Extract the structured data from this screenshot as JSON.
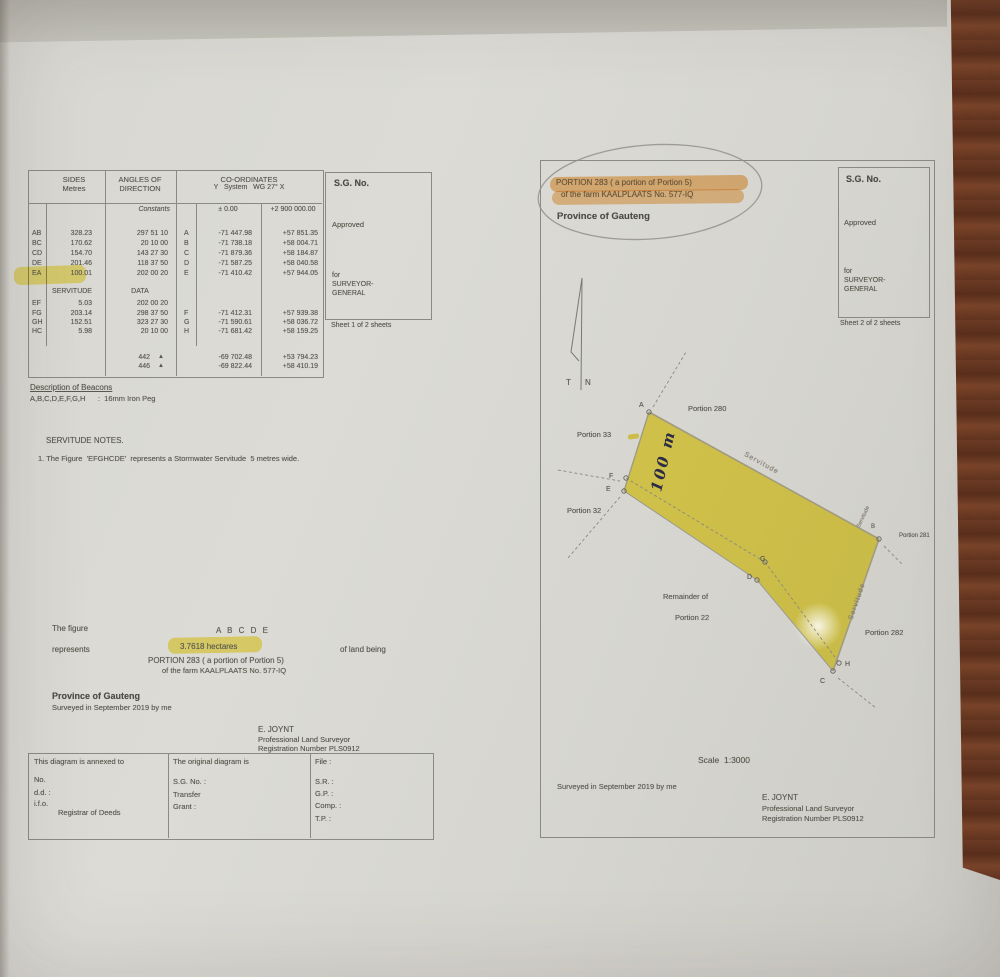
{
  "left_page": {
    "table": {
      "sides_header_1": "SIDES",
      "sides_header_2": "Metres",
      "angles_header_1": "ANGLES OF",
      "angles_header_2": "DIRECTION",
      "coords_header_1": "CO-ORDINATES",
      "coords_header_2": "Y   System   WG 27° X",
      "constants_label": "Constants",
      "const_y": "± 0.00",
      "const_x": "+2 900 000.00",
      "rows": [
        {
          "pair": "AB",
          "metres": "328.23",
          "angle": "297 51 10",
          "pt": "A",
          "y": "-71 447.98",
          "x": "+57 851.35"
        },
        {
          "pair": "BC",
          "metres": "170.62",
          "angle": "20 10 00",
          "pt": "B",
          "y": "-71 738.18",
          "x": "+58 004.71"
        },
        {
          "pair": "CD",
          "metres": "154.70",
          "angle": "143 27 30",
          "pt": "C",
          "y": "-71 879.36",
          "x": "+58 184.87"
        },
        {
          "pair": "DE",
          "metres": "201.46",
          "angle": "118 37 50",
          "pt": "D",
          "y": "-71 587.25",
          "x": "+58 040.58"
        },
        {
          "pair": "EA",
          "metres": "100.01",
          "angle": "202 00 20",
          "pt": "E",
          "y": "-71 410.42",
          "x": "+57 944.05"
        }
      ],
      "servitude_label": "SERVITUDE",
      "data_label": "DATA",
      "serv_rows": [
        {
          "pair": "EF",
          "metres": "5.03",
          "angle": "202 00 20",
          "pt": "",
          "y": "",
          "x": ""
        },
        {
          "pair": "FG",
          "metres": "203.14",
          "angle": "298 37 50",
          "pt": "F",
          "y": "-71 412.31",
          "x": "+57 939.38"
        },
        {
          "pair": "GH",
          "metres": "152.51",
          "angle": "323 27 30",
          "pt": "G",
          "y": "-71 590.61",
          "x": "+58 036.72"
        },
        {
          "pair": "HC",
          "metres": "5.98",
          "angle": "20 10 00",
          "pt": "H",
          "y": "-71 681.42",
          "x": "+58 159.25"
        }
      ],
      "ref_rows": [
        {
          "num": "442",
          "sym": "▲",
          "y": "-69 702.48",
          "x": "+53 794.23"
        },
        {
          "num": "446",
          "sym": "▲",
          "y": "-69 822.44",
          "x": "+58 410.19"
        }
      ]
    },
    "sg_box": {
      "title": "S.G. No.",
      "approved": "Approved",
      "for": "for",
      "surveyor": "SURVEYOR-",
      "general": "GENERAL",
      "sheet": "Sheet 1 of 2 sheets"
    },
    "beacons_heading": "Description of Beacons",
    "beacons_line": "A,B,C,D,E,F,G,H      :  16mm Iron Peg",
    "servitude_notes_heading": "SERVITUDE NOTES.",
    "servitude_note_1": "1. The Figure  'EFGHCDE'  represents a Stormwater Servitude  5 metres wide.",
    "figure": {
      "label": "The figure",
      "letters": "A B C D E",
      "represents": "represents",
      "area": "3.7618 hectares",
      "of_land": "of land being",
      "portion": "PORTION 283 ( a portion of Portion 5)",
      "farm": "of the farm KAALPLAATS No. 577-IQ"
    },
    "province": "Province of Gauteng",
    "surveyed": "Surveyed in September 2019 by me",
    "surveyor": {
      "name": "E. JOYNT",
      "title": "Professional Land Surveyor",
      "reg": "Registration Number PLS0912"
    },
    "bottom_table": {
      "col1_title": "This diagram is annexed to",
      "col1_lines": [
        "No.",
        "d.d. :",
        "i.f.o.",
        "Registrar of Deeds"
      ],
      "col2_title": "The original diagram is",
      "col2_lines": [
        "S.G. No. :",
        "Transfer",
        "Grant :"
      ],
      "col3_title": "File :",
      "col3_lines": [
        "S.R. :",
        "G.P. :",
        "Comp. :",
        "T.P. :"
      ]
    }
  },
  "right_page": {
    "portion_line1": "PORTION 283 ( a portion of Portion 5)",
    "portion_line2": "of the farm KAALPLAATS No. 577-IQ",
    "province": "Province of Gauteng",
    "sg_box": {
      "title": "S.G. No.",
      "approved": "Approved",
      "for": "for",
      "surveyor": "SURVEYOR-",
      "general": "GENERAL",
      "sheet": "Sheet 2 of 2 sheets"
    },
    "north_t": "T",
    "north_n": "N",
    "labels": {
      "portion_280": "Portion 280",
      "portion_33": "Portion 33",
      "portion_32": "Portion 32",
      "portion_281": "Portion 281",
      "portion_282": "Portion 282",
      "remainder_1": "Remainder of",
      "remainder_2": "Portion 22",
      "servitude_top": "Servitude",
      "servitude_right": "Servitude",
      "servitude_corner": "Servitude"
    },
    "beacons": {
      "A": "A",
      "B": "B",
      "C": "C",
      "D": "D",
      "E": "E",
      "F": "F",
      "G": "G",
      "H": "H"
    },
    "annotation_100m": "100 m",
    "scale": "Scale  1:3000",
    "surveyed": "Surveyed in September 2019 by me",
    "surveyor": {
      "name": "E. JOYNT",
      "title": "Professional Land Surveyor",
      "reg": "Registration Number PLS0912"
    }
  },
  "colors": {
    "highlight_yellow": "#f2df3c",
    "highlight_orange": "#f0a44e",
    "pen_ink": "#2c2c44",
    "paper": "#d9d8d3",
    "wood": "#64341e"
  }
}
